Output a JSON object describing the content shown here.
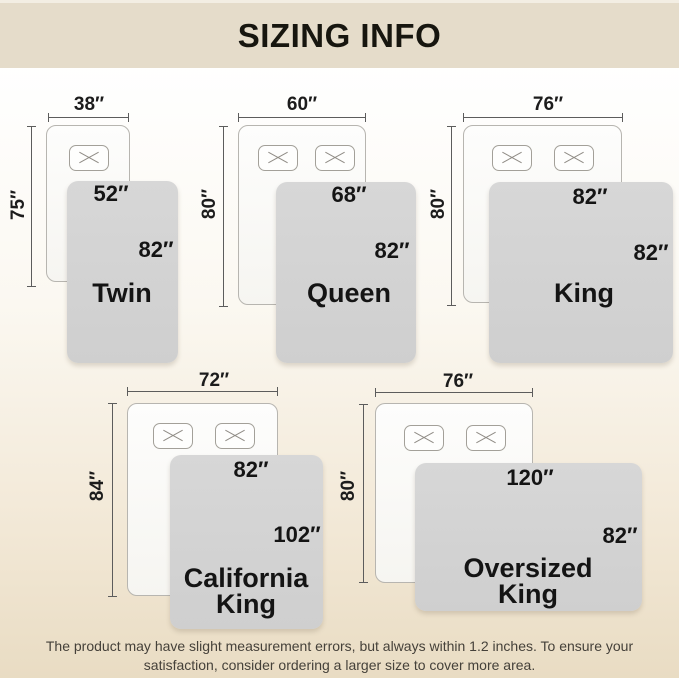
{
  "header": {
    "title": "SIZING INFO"
  },
  "footer": {
    "line1": "The product may have slight measurement errors, but always within 1.2 inches. To ensure your",
    "line2": "satisfaction, consider ordering a larger size to cover more area."
  },
  "colors": {
    "header_bg": "#e5dcca",
    "page_gradient_top": "#ffffff",
    "page_gradient_bottom": "#e9dcc3",
    "blanket_gray": "#d3d3d3",
    "bed_fill": "#fbfaf8",
    "bed_border": "#b7b5b0",
    "measure_line": "#5c5c5c",
    "label_text": "#141414",
    "footer_text": "#45413a"
  },
  "diagrams": [
    {
      "id": "twin",
      "name": "Twin",
      "bed_width": "38″",
      "bed_height": "75″",
      "blanket_width": "52″",
      "blanket_height": "82″",
      "pillows": 1
    },
    {
      "id": "queen",
      "name": "Queen",
      "bed_width": "60″",
      "bed_height": "80″",
      "blanket_width": "68″",
      "blanket_height": "82″",
      "pillows": 2
    },
    {
      "id": "king",
      "name": "King",
      "bed_width": "76″",
      "bed_height": "80″",
      "blanket_width": "82″",
      "blanket_height": "82″",
      "pillows": 2
    },
    {
      "id": "california-king",
      "name": "California King",
      "bed_width": "72″",
      "bed_height": "84″",
      "blanket_width": "82″",
      "blanket_height": "102″",
      "pillows": 2
    },
    {
      "id": "oversized-king",
      "name": "Oversized King",
      "bed_width": "76″",
      "bed_height": "80″",
      "blanket_width": "120″",
      "blanket_height": "82″",
      "pillows": 2
    }
  ]
}
